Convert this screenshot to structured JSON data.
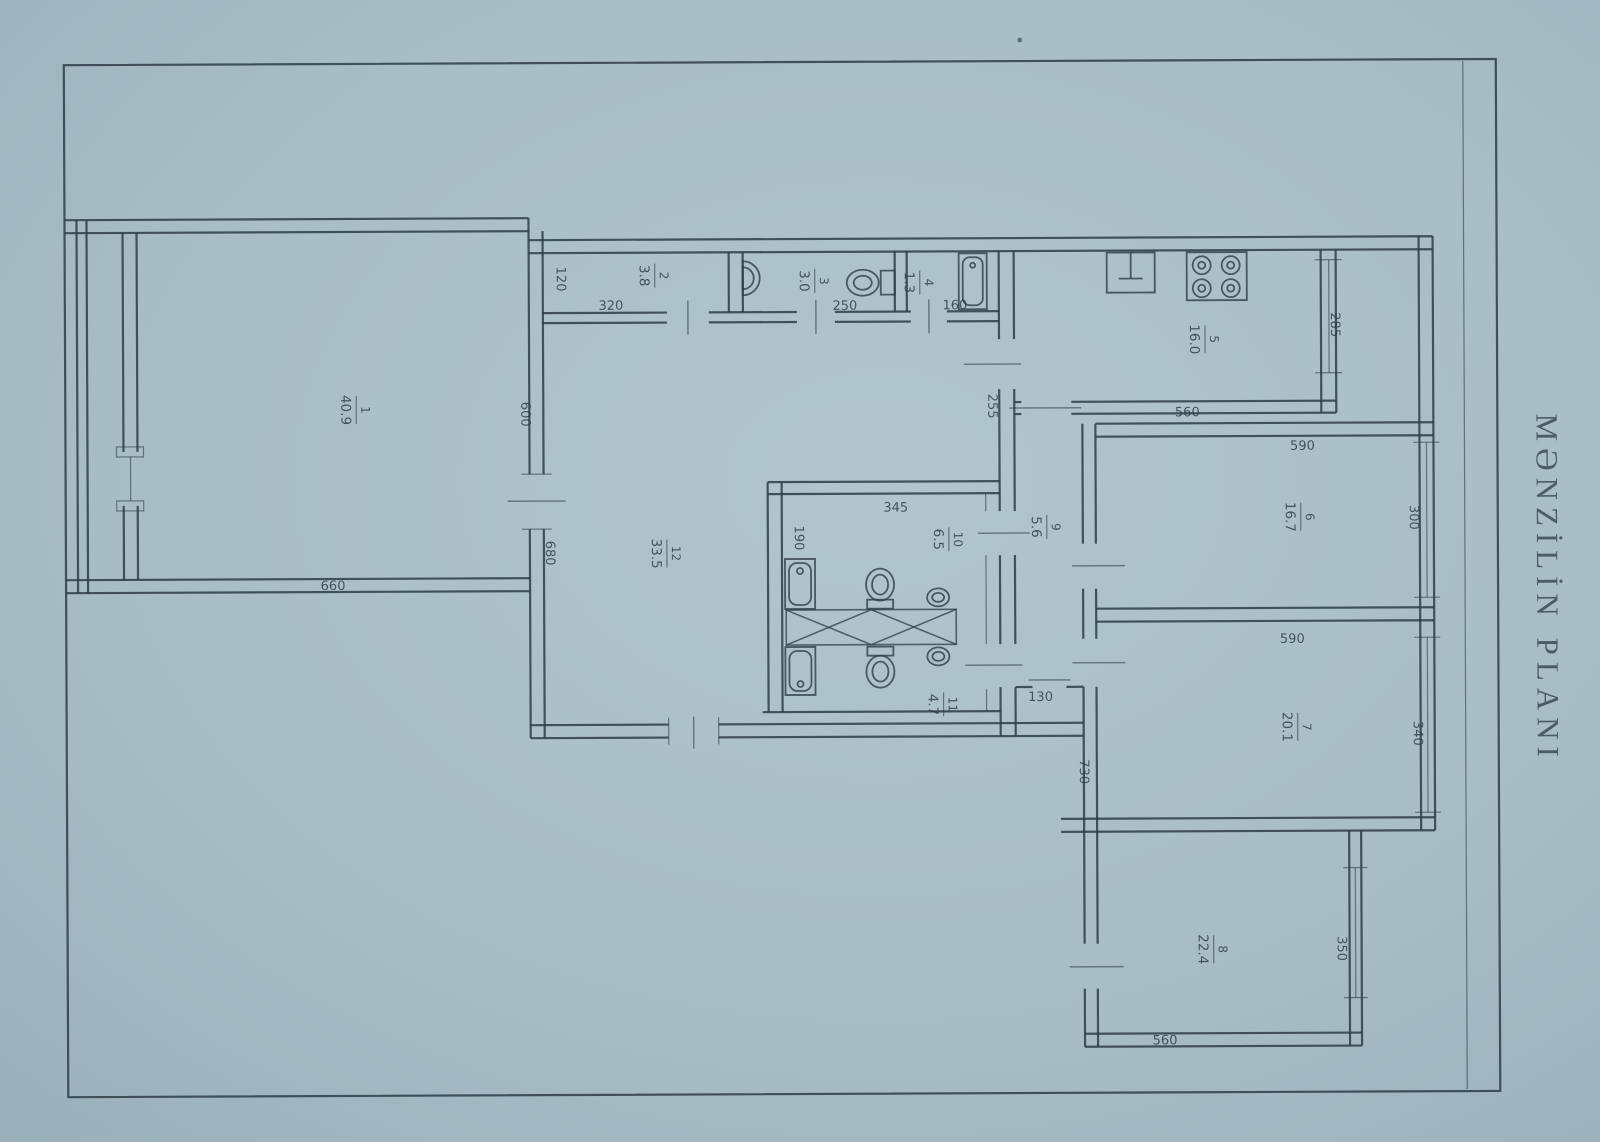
{
  "title": "MƏNZİLİN PLANI",
  "colors": {
    "paper": "#a9bdc6",
    "ink": "#2e3d46"
  },
  "rooms": [
    {
      "number": "1",
      "area": "40.9"
    },
    {
      "number": "2",
      "area": "3.8"
    },
    {
      "number": "3",
      "area": "3.0"
    },
    {
      "number": "4",
      "area": "1.3"
    },
    {
      "number": "5",
      "area": "16.0"
    },
    {
      "number": "6",
      "area": "16.7"
    },
    {
      "number": "7",
      "area": "20.1"
    },
    {
      "number": "8",
      "area": "22.4"
    },
    {
      "number": "9",
      "area": "5.6"
    },
    {
      "number": "10",
      "area": "6.5"
    },
    {
      "number": "11",
      "area": "4.7"
    },
    {
      "number": "12",
      "area": "33.5"
    }
  ],
  "dimensions": {
    "room1_width": "660",
    "wall_upper": "600",
    "wall_lower": "680",
    "room2_depth": "120",
    "room2_width": "320",
    "room3_width": "250",
    "room4_width": "160",
    "hall_opening": "255",
    "kitchen_width": "560",
    "kitchen_depth": "285",
    "room6_width": "590",
    "room6_window": "300",
    "room7_width": "590",
    "room7_window": "340",
    "corridor_depth": "730",
    "door_width": "130",
    "bath_width": "345",
    "bath_depth": "190",
    "room8_width": "560",
    "room8_window": "350"
  }
}
